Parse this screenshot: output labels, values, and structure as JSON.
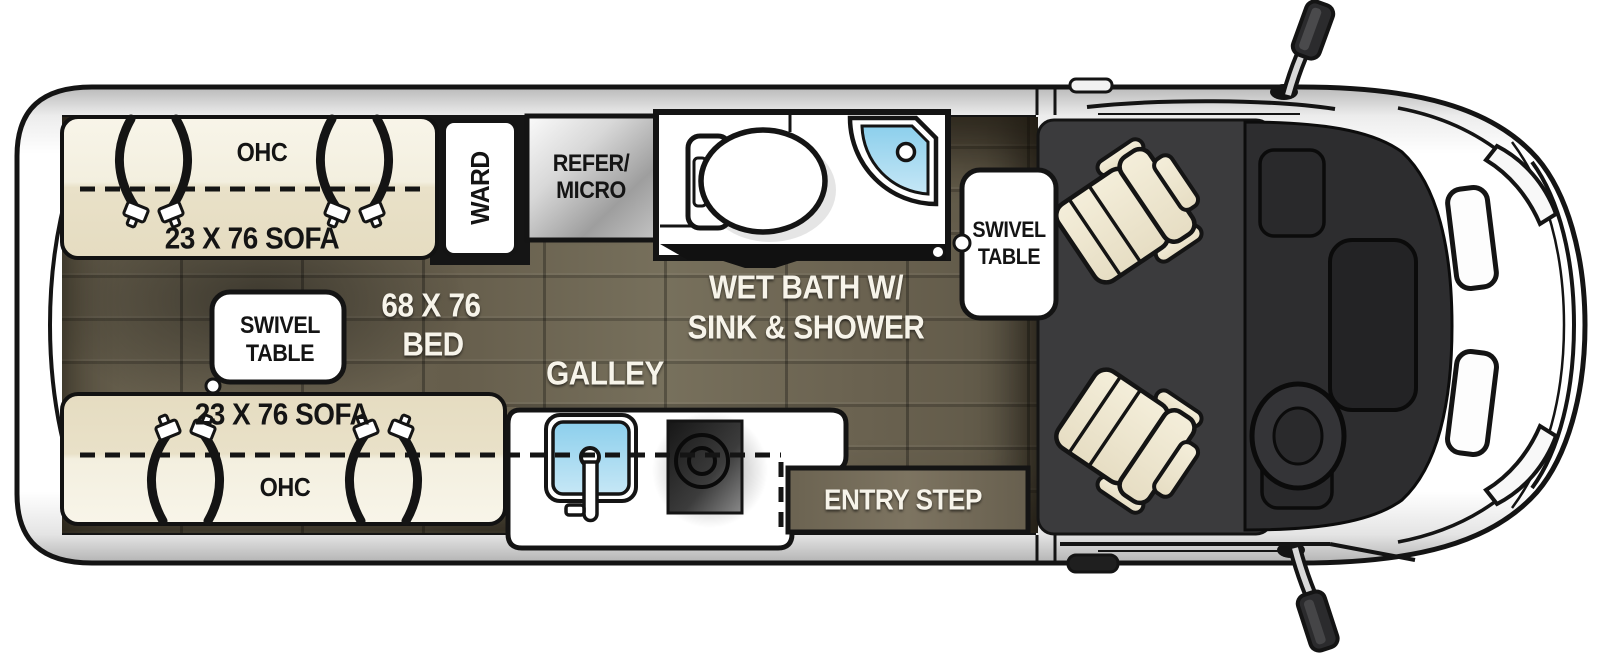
{
  "meta": {
    "type": "rv-class-b-floorplan-top-view"
  },
  "colors": {
    "van_body": "#ffffff",
    "outline": "#141414",
    "wood_floor": "#6b6351",
    "sofa_cream": "#f2ecd9",
    "sink_blue": "#8fd0ec",
    "cab_dark": "#3a3a3c",
    "label_white": "#f7f4ea",
    "label_black": "#141414"
  },
  "labels": {
    "top_sofa_ohc": "OHC",
    "top_sofa": "23 X 76 SOFA",
    "wardrobe": "WARD",
    "refer_line1": "REFER/",
    "refer_line2": "MICRO",
    "wet_bath_line1": "WET BATH W/",
    "wet_bath_line2": "SINK & SHOWER",
    "swivel_table_front_line1": "SWIVEL",
    "swivel_table_front_line2": "TABLE",
    "swivel_table_rear_line1": "SWIVEL",
    "swivel_table_rear_line2": "TABLE",
    "bed_line1": "68 X 76",
    "bed_line2": "BED",
    "galley": "GALLEY",
    "entry_step": "ENTRY STEP",
    "bottom_sofa": "23 X 76 SOFA",
    "bottom_sofa_ohc": "OHC"
  }
}
